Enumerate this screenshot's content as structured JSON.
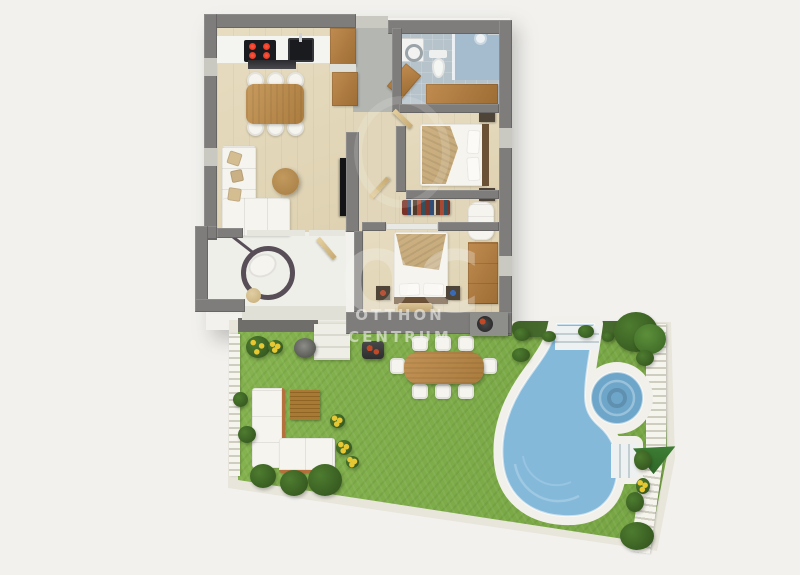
{
  "watermark": {
    "monogram": "OC",
    "line1": "OTTHON",
    "line2": "CENTRUM"
  },
  "colors": {
    "bg": "#f2f1ee",
    "wall": "#7e7d7b",
    "wall-light": "#c9c8c1",
    "wood-floor": "#e7dcc0",
    "hall-floor": "#b3b6b1",
    "corridor-floor": "#e1d6ba",
    "bath-floor": "#b6c3cb",
    "shower-floor": "#a4bccd",
    "terrace-floor": "#efefe9",
    "wood": "#c08b4f",
    "wood-dark": "#9c6d35",
    "counter-white": "#f4f4f0",
    "appliance-black": "#1a1b1e",
    "burner-red": "#d5281d",
    "fabric-white": "#f5f4ee",
    "pillow-tan": "#d5bd92",
    "throw-tan": "#c3a878",
    "headboard-brown": "#6b5136",
    "frame-dark": "#4e4438",
    "grass": "#7cab48",
    "grass-light": "#8fbc55",
    "hedge": "#42622a",
    "bush": "#4d7c2f",
    "flower-yellow": "#e8c832",
    "pool-deck": "#f1f0ea",
    "pool-water": "#84b9da",
    "pool-water-deep": "#6ea6ca",
    "fence": "#f5f4ed",
    "fence-gap": "#cfcdc0",
    "edging": "#e8e6db",
    "step-white": "#eeeee6",
    "watermark-ink": "#f5f5f3"
  }
}
